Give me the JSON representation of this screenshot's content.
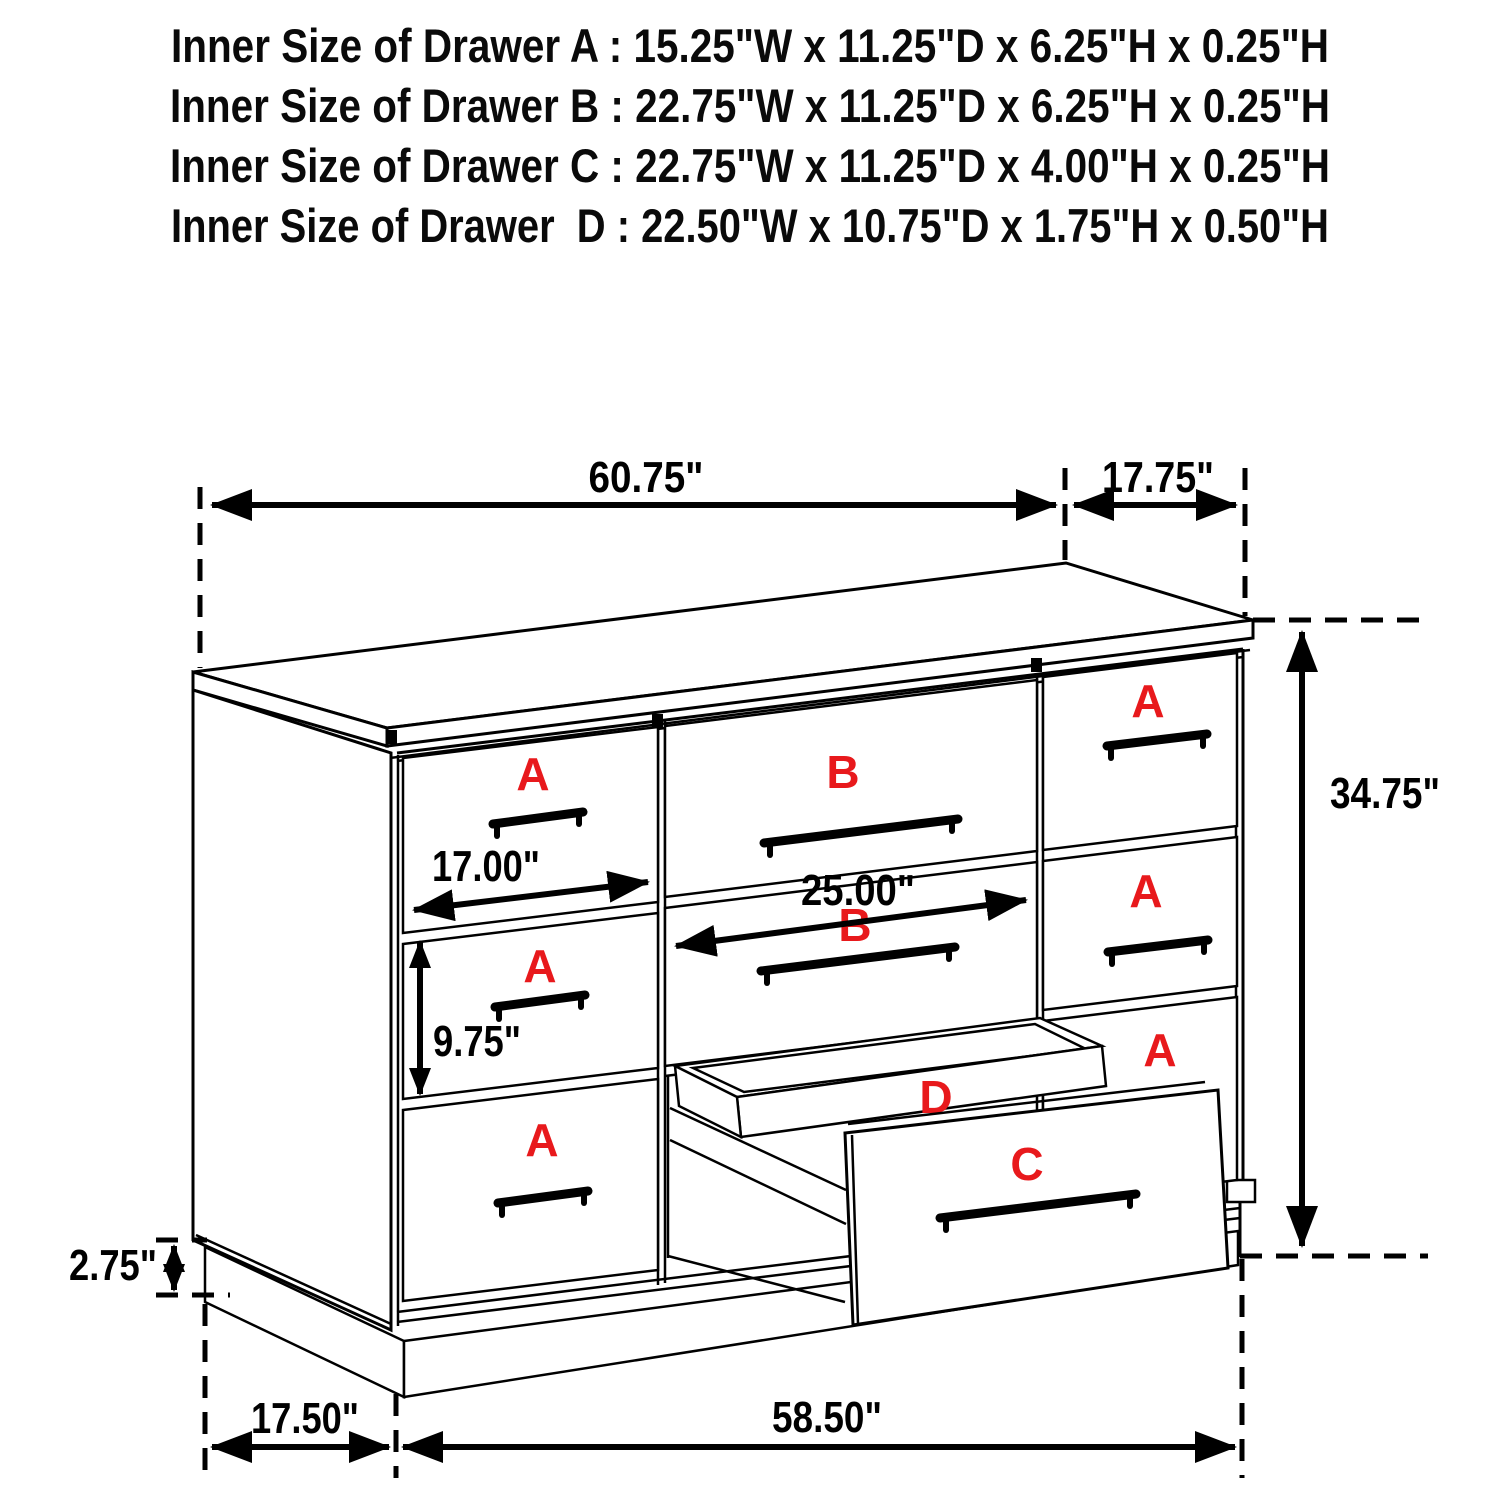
{
  "title_block": {
    "lines": [
      "Inner Size of Drawer A : 15.25\"W x 11.25\"D x 6.25\"H x 0.25\"H",
      "Inner Size of Drawer B : 22.75\"W x 11.25\"D x 6.25\"H x 0.25\"H",
      "Inner Size of Drawer C : 22.75\"W x 11.25\"D x 4.00\"H x 0.25\"H",
      "Inner Size of Drawer  D : 22.50\"W x 10.75\"D x 1.75\"H x 0.50\"H"
    ]
  },
  "diagram": {
    "dimensions": {
      "top_width": "60.75\"",
      "top_depth": "17.75\"",
      "overall_height": "34.75\"",
      "drawer_b_width": "25.00\"",
      "drawer_a_width": "17.00\"",
      "drawer_a_height": "9.75\"",
      "base_height": "2.75\"",
      "base_depth": "17.50\"",
      "base_width": "58.50\""
    },
    "drawer_labels": {
      "left_column": [
        "A",
        "A",
        "A"
      ],
      "middle_column": [
        "B",
        "B"
      ],
      "right_column": [
        "A",
        "A",
        "A"
      ],
      "tray": "D",
      "pulled_drawer": "C"
    },
    "colors": {
      "label_red": "#e8191c",
      "line_black": "#000000"
    }
  }
}
